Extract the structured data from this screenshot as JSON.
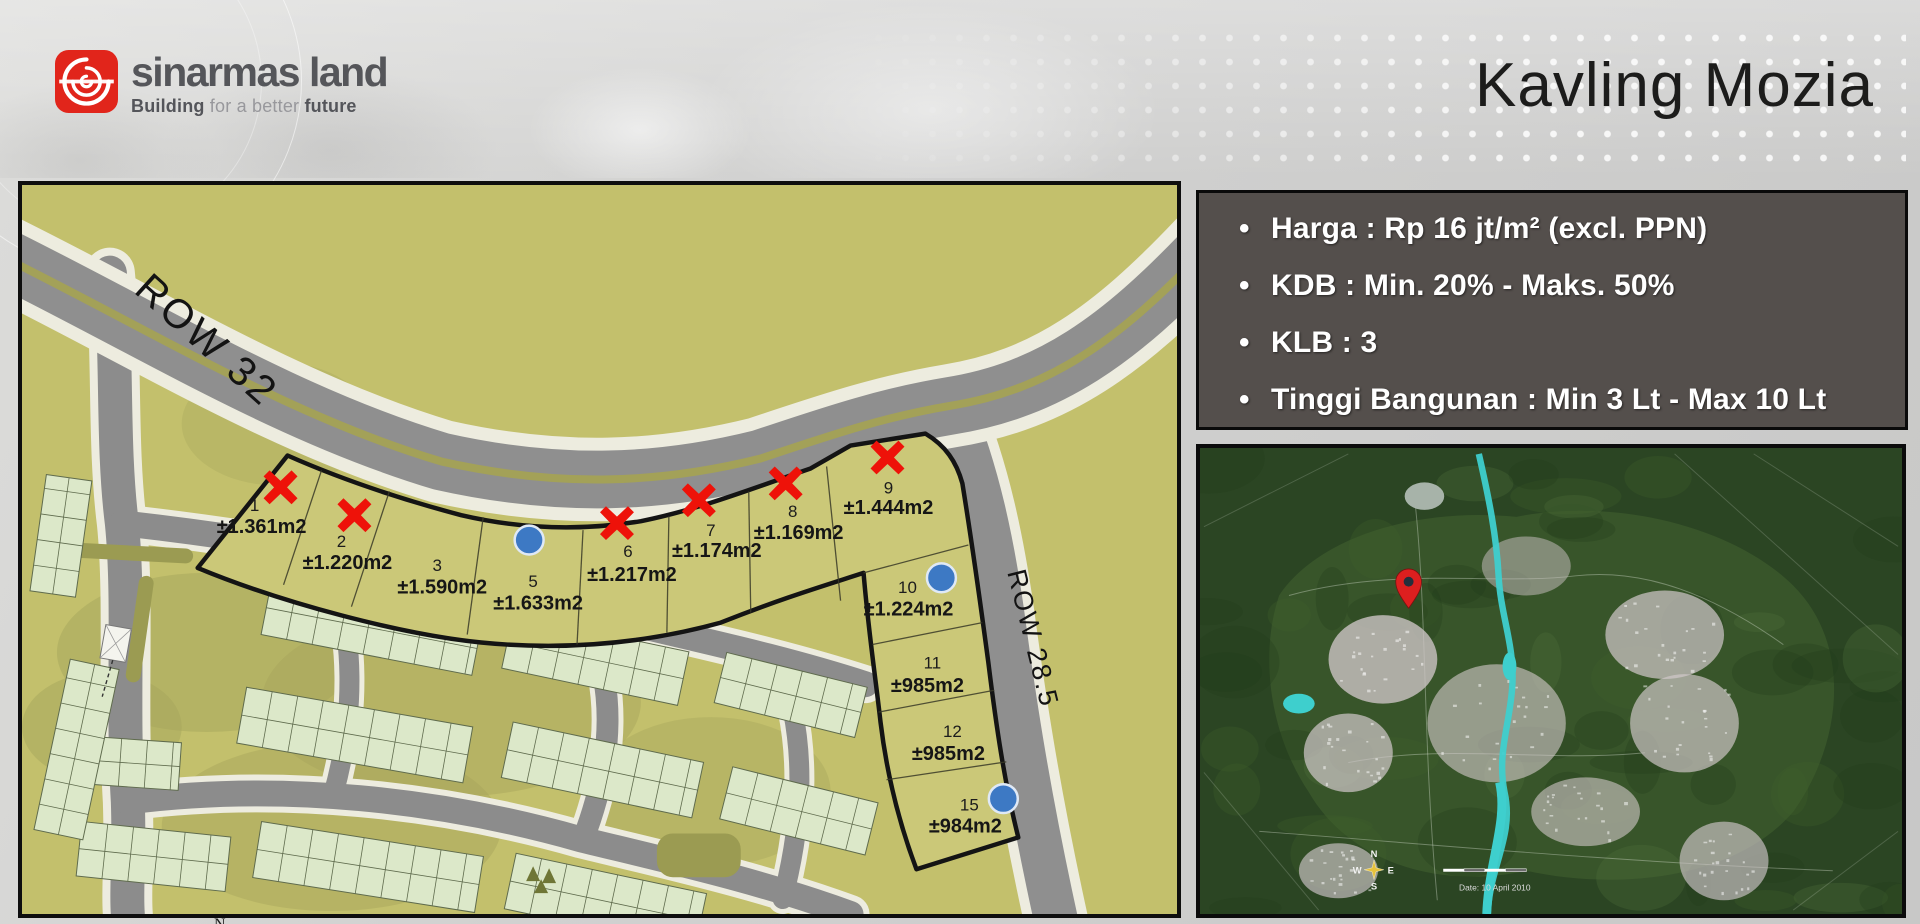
{
  "header": {
    "brand": "sinarmas land",
    "tagline": {
      "bold_lead": "Building",
      "light_mid": "for a better",
      "bold_tail": "future"
    },
    "title": "Kavling Mozia",
    "colors": {
      "logo_red": "#e1251b",
      "brand_text": "#55565a",
      "title_text": "#1c1c1b"
    }
  },
  "info_box": {
    "bullet": "•",
    "items": [
      "Harga : Rp 16 jt/m² (excl. PPN)",
      "KDB : Min. 20% - Maks. 50%",
      "KLB : 3",
      "Tinggi Bangunan : Min 3 Lt - Max 10 Lt"
    ],
    "colors": {
      "background": "#544f4c",
      "text": "#ffffff"
    }
  },
  "site_plan": {
    "row32_label": "ROW 32",
    "row285_label": "ROW 28.5",
    "north_label": "N",
    "plots": [
      {
        "number": "1",
        "area": "±1.361m2",
        "marker": "red-x"
      },
      {
        "number": "2",
        "area": "±1.220m2",
        "marker": "red-x"
      },
      {
        "number": "3",
        "area": "±1.590m2",
        "marker": "none"
      },
      {
        "number": "5",
        "area": "±1.633m2",
        "marker": "blue-circle"
      },
      {
        "number": "6",
        "area": "±1.217m2",
        "marker": "red-x"
      },
      {
        "number": "7",
        "area": "±1.174m2",
        "marker": "red-x"
      },
      {
        "number": "8",
        "area": "±1.169m2",
        "marker": "red-x"
      },
      {
        "number": "9",
        "area": "±1.444m2",
        "marker": "red-x"
      },
      {
        "number": "10",
        "area": "±1.224m2",
        "marker": "blue-circle"
      },
      {
        "number": "11",
        "area": "±985m2",
        "marker": "none"
      },
      {
        "number": "12",
        "area": "±985m2",
        "marker": "none"
      },
      {
        "number": "15",
        "area": "±984m2",
        "marker": "blue-circle"
      }
    ],
    "colors": {
      "x_marker": "#ee1209",
      "circle_marker": "#3d79c4",
      "plot_fill": "#cbc878",
      "base": "#c3c06c",
      "road": "#8f8f8f",
      "sidewalk": "#edecdf"
    }
  },
  "location_map": {
    "compass": {
      "n": "N",
      "w": "W",
      "e": "E",
      "s": "S"
    },
    "date_label": "Date: 10 April 2010",
    "colors": {
      "pin": "#dd1f1f",
      "river": "#3ecfcd",
      "ground": "#2b4523"
    }
  }
}
